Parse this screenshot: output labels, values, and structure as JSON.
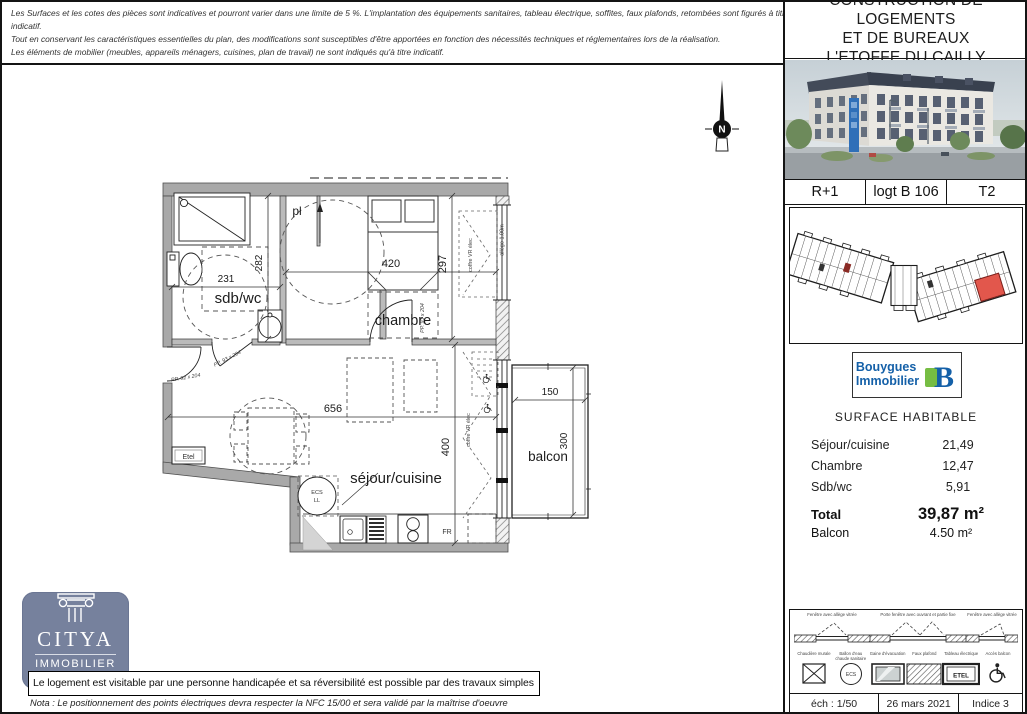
{
  "disclaimer": {
    "line1": "Les Surfaces et les cotes des pièces sont indicatives et pourront varier dans une limite de 5 %. L'implantation des équipements sanitaires, tableau électrique, soffites, faux plafonds, retombées sont figurés à titre indicatif.",
    "line2": "Tout en conservant les caractéristiques essentielles du plan, des modifications sont susceptibles d'être apportées en fonction des nécessités techniques et réglementaires lors de la réalisation.",
    "line3": "Les éléments de mobilier (meubles, appareils ménagers, cuisines, plan de travail) ne sont indiqués qu'à titre indicatif."
  },
  "title_block": {
    "line1": "CONSTRUCTION DE LOGEMENTS",
    "line2": "ET DE BUREAUX",
    "line3": "L'ETOFFE DU CAILLY"
  },
  "unit": {
    "level": "R+1",
    "lot": "logt B 106",
    "type": "T2"
  },
  "developer": {
    "line1": "Bouygues",
    "line2": "Immobilier",
    "blue": "#1460a8",
    "green": "#76bd43"
  },
  "surfaces": {
    "heading": "SURFACE HABITABLE",
    "rows": [
      {
        "label": "Séjour/cuisine",
        "value": "21,49"
      },
      {
        "label": "Chambre",
        "value": "12,47"
      },
      {
        "label": "Sdb/wc",
        "value": "5,91"
      }
    ],
    "total_label": "Total",
    "total_value": "39,87 m²",
    "balcony_label": "Balcon",
    "balcony_value": "4.50 m²"
  },
  "plan": {
    "rooms": {
      "sdb": "sdb/wc",
      "chambre": "chambre",
      "sejour": "séjour/cuisine",
      "balcon": "balcon",
      "placard": "pl"
    },
    "dims": {
      "sdb_w": "231",
      "sdb_h": "282",
      "chambre_w": "420",
      "chambre_h": "297",
      "sejour_w": "656",
      "sejour_h": "400",
      "balcon_w": "150",
      "balcon_h": "300"
    },
    "annotations": {
      "door_sdb": "PP. 93 x 204",
      "door_sejour": "PP. 93 x 204",
      "door_entry": "PP. 92 x 204",
      "coffre": "coffre VR élec",
      "allege": "allège 1.00m",
      "etel": "Etel",
      "ecs": "ECS",
      "ll": "LL",
      "fr": "FR",
      "north": "N"
    }
  },
  "legend": {
    "windows": [
      "Fenêtre avec allège vitrée",
      "Porte fenêtre avec ouvrant et partie fixe",
      "Fenêtre avec allège vitrée"
    ],
    "items": [
      {
        "label": "Chaudière murale",
        "icon": "crossed-box"
      },
      {
        "label": "Ballon d'eau chaude sanitaire",
        "icon": "ecs-circle",
        "text": "ECS"
      },
      {
        "label": "Gaine d'évacuation",
        "icon": "framed-panel"
      },
      {
        "label": "Faux plafond",
        "icon": "hatched-rect"
      },
      {
        "label": "Tableau électrique",
        "icon": "etel-box",
        "text": "ETEL"
      },
      {
        "label": "Accès balcon",
        "icon": "wheelchair"
      }
    ]
  },
  "footer": {
    "scale": "éch : 1/50",
    "date": "26 mars 2021",
    "index": "Indice 3"
  },
  "agency": {
    "name": "CITYA",
    "subtitle": "IMMOBILIER",
    "color": "#76819d"
  },
  "notes": {
    "accessibility": "Le logement est visitable par une personne handicapée et sa réversibilité est possible par des travaux simples",
    "nota": "Nota : Le positionnement des points électriques devra respecter la NFC 15/00 et sera validé par la maîtrise d'oeuvre"
  }
}
